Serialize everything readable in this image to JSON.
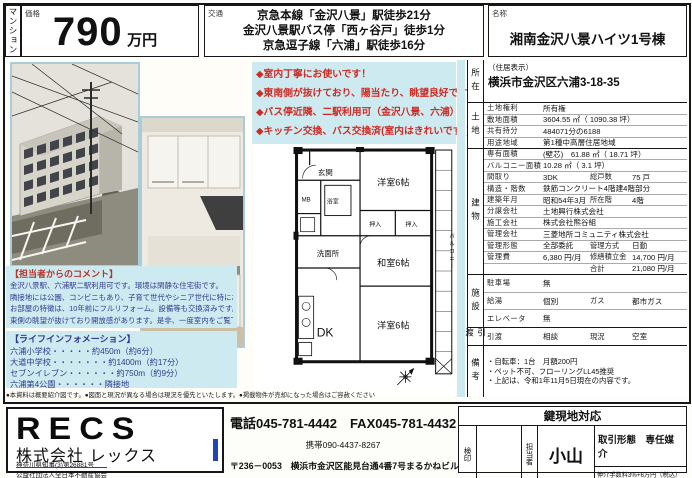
{
  "header": {
    "category": "マンション",
    "price_label": "価格",
    "price_value": "790",
    "price_unit": "万円",
    "access_label": "交通",
    "access_lines": [
      "京急本線「金沢八景」駅徒歩21分",
      "金沢八景駅バス停「西ヶ谷戸」徒歩1分",
      "京急逗子線「六浦」駅徒歩16分"
    ],
    "name_label": "名称",
    "name_value": "湘南金沢八景ハイツ1号棟"
  },
  "highlights": {
    "lines": [
      "◆室内丁寧にお使いです！",
      "◆東南側が抜けており、陽当たり、眺望良好です！",
      "◆バス停近隣、二駅利用可（金沢八景、六浦）",
      "◆キッチン交換、バス交換済(室内はきれいです。)"
    ]
  },
  "agent_comment": {
    "title": "【担当者からのコメント】",
    "lines": [
      "金沢八景駅、六浦駅二駅利用可です。環境は閑静な住宅街です。",
      "隣接地には公園、コンビニもあり、子育て世代やシニア世代に特におすすめです。",
      "お部屋の特徴は、10年前にフルリフォーム。設備等も交換済みです。",
      "東側の眺望が抜けており開放感があります。是非、一度室内をご覧下さい！"
    ]
  },
  "life_info": {
    "title": "【ライフインフォメーション】",
    "lines": [
      "六浦小学校・・・・・約450m（約6分）",
      "大道中学校・・・・・・・約1400m（約17分）",
      "セブンイレブン・・・・・・約750m（約9分）",
      "六浦第4公園・・・・・・隣接地"
    ]
  },
  "fine_print": "●本資料は概要紹介図です。●図面と現況が異なる場合は現況を優先といたします。●掲載物件が売却になった場合はご容赦ください",
  "floor_plan": {
    "rooms": {
      "genkan": "玄関",
      "mb": "MB",
      "bath": "浴室",
      "wash": "洗面所",
      "west1": "洋室6帖",
      "closet1": "押入",
      "closet2": "押入",
      "washitsu": "和室6帖",
      "west2": "洋室6帖",
      "dk": "DK",
      "balcony": "バルコニー"
    }
  },
  "details": {
    "location": {
      "tag": "所在",
      "note": "（住居表示）",
      "address": "横浜市金沢区六浦3-18-35"
    },
    "land": {
      "tag": "土地",
      "rows": [
        {
          "l": "土地権利",
          "v": "所有権"
        },
        {
          "l": "敷地面積",
          "v": "3604.55 ㎡（ 1090.38 坪）"
        },
        {
          "l": "共有持分",
          "v": "484071分の6188"
        },
        {
          "l": "用途地域",
          "v": "第1種中高層住居地域"
        }
      ]
    },
    "building": {
      "tag": "建物",
      "rows": [
        {
          "l": "専有面積",
          "v": "(壁芯)　61.88 ㎡（ 18.71 坪）"
        },
        {
          "l": "バルコニー面積",
          "v": "10.28 ㎡（ 3.1 坪）"
        },
        {
          "l": "間取り",
          "v": "3DK",
          "l2": "総戸数",
          "v2": "75 戸"
        },
        {
          "l": "構造・階数",
          "v": "鉄筋コンクリート4階建4階部分"
        },
        {
          "l": "建築年月",
          "v": "昭和54年3月",
          "l2": "所在階",
          "v2": "4階"
        },
        {
          "l": "分譲会社",
          "v": "土地興行株式会社"
        },
        {
          "l": "施工会社",
          "v": "株式会社熊谷組"
        },
        {
          "l": "管理会社",
          "v": "三菱地所コミュニティ株式会社"
        },
        {
          "l": "管理形態",
          "v": "全部委託",
          "l2": "管理方式",
          "v2": "日勤"
        },
        {
          "l": "管理費",
          "v": "6,380 円/月",
          "l2": "修繕積立金",
          "v2": "14,700 円/月"
        },
        {
          "l": "",
          "v": "",
          "l2": "合計",
          "v2": "21,080 円/月"
        }
      ]
    },
    "facility": {
      "tag": "施設",
      "rows": [
        {
          "l": "駐車場",
          "v": "無"
        },
        {
          "l": "給湯",
          "v": "個別",
          "l2": "ガス",
          "v2": "都市ガス"
        },
        {
          "l": "エレベータ",
          "v": "無"
        }
      ]
    },
    "handover": {
      "tag": "引渡",
      "rows": [
        {
          "l": "引渡",
          "v": "相談",
          "l2": "現況",
          "v2": "空室"
        }
      ]
    },
    "remarks": {
      "tag": "備考",
      "lines": [
        "・自転車：1台　月額200円",
        "・ペット不可、フローリングLL45推奨",
        "・上記は、令和1年11月5日現在の内容です。"
      ]
    }
  },
  "footer": {
    "company": {
      "logo": "RECS",
      "name": "株式会社 レックス",
      "license": "神奈川県知事(3)第26881号",
      "association": "公益社団法人全日本不動産協会"
    },
    "contact": {
      "tel_fax": "電話045-781-4442　FAX045-781-4432",
      "mobile": "携帯090-4437-8267",
      "address": "〒236－0053　横浜市金沢区能見台通4番7号まるかねビル3-ノ"
    },
    "keybox": {
      "title": "鍵現地対応",
      "seal_label": "検印",
      "staff_label": "担当者",
      "staff_name": "小山",
      "deal_type": "取引形態　専任媒介",
      "fee": "仲介手数料3%+6万円（税込）"
    }
  },
  "colors": {
    "cyan": "#cdeaf0",
    "red": "#cf2a23",
    "navy": "#333a8f",
    "photo_border": "#a8cdd8"
  }
}
